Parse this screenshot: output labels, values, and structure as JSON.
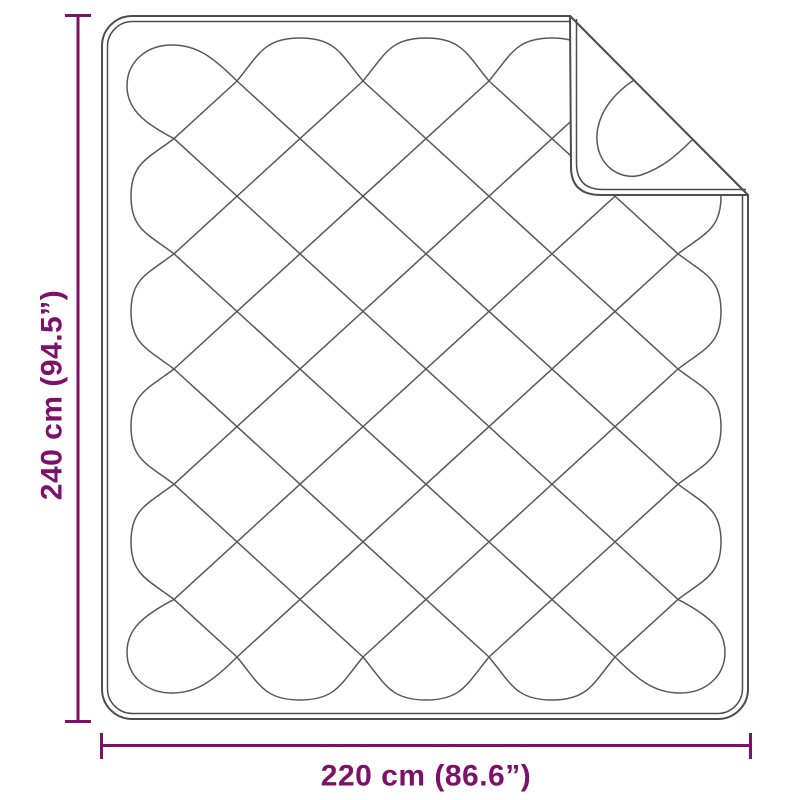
{
  "figure": {
    "name": "quilted-blanket-diagram",
    "description": "Line drawing of a quilted pad with diamond stitching and folded top-right corner"
  },
  "dimension_annotations": {
    "height": {
      "label": "240 cm (94.5”)"
    },
    "width": {
      "label": "220 cm (86.6”)"
    }
  },
  "colors": {
    "accent_purple": "#7d1169",
    "outline_gray": "#4d4d4d",
    "quilt_line_gray": "#585858",
    "background": "#ffffff"
  }
}
